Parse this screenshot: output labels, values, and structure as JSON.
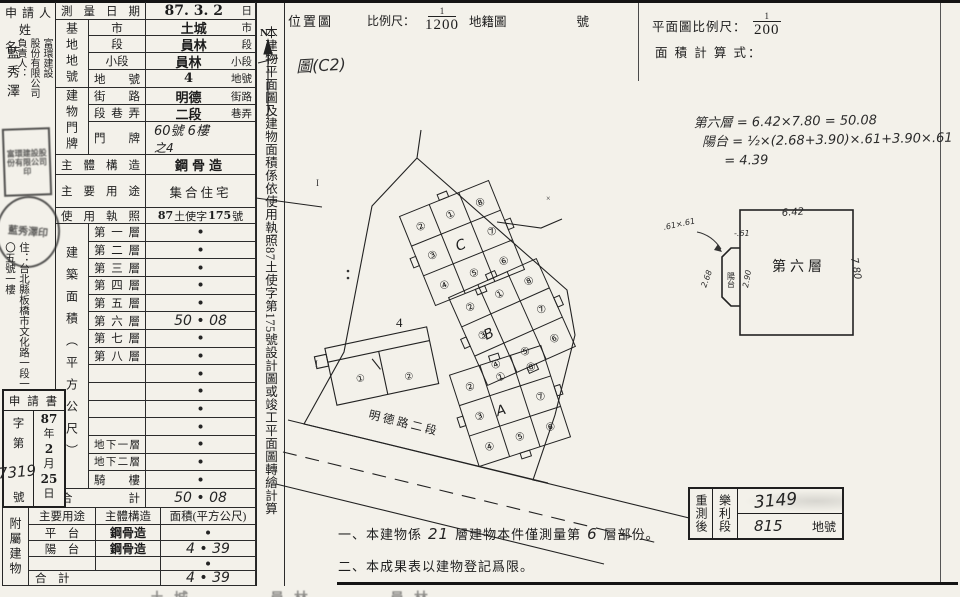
{
  "applicant": {
    "header_line1": "申 請 人",
    "header_line2": "姓　名",
    "company_block": "富環建設\n股份有限公司\n負責人：",
    "principal_name": "藍秀澤",
    "address": "住：台北縣板橋市文化路一段一〇五號一樓",
    "seal_square": "富環建設股份有限公司印",
    "seal_round": "藍秀澤印"
  },
  "form": {
    "survey_date": {
      "label": "測量日期",
      "value": "87. 3. 2",
      "suffix": "日"
    },
    "base": {
      "group": "基地地號",
      "rows": [
        {
          "label": "市",
          "value": "土城",
          "suffix": "市"
        },
        {
          "label": "段",
          "value": "員林",
          "suffix": "段"
        },
        {
          "label": "小段",
          "value": "員林",
          "suffix": "小段"
        },
        {
          "label": "地號",
          "value": "4",
          "suffix": "地號"
        }
      ]
    },
    "premise": {
      "group": "建物門牌",
      "street": {
        "label": "街路",
        "value": "明德",
        "suffix": "街路"
      },
      "section": {
        "label": "段巷弄",
        "value": "二段",
        "suffix": "巷弄"
      },
      "door": {
        "label": "門牌",
        "line1": "60號 6樓",
        "line2": "之4"
      }
    },
    "structure": {
      "label": "主體構造",
      "value": "鋼骨造"
    },
    "usage": {
      "label": "主要用途",
      "value": "集合住宅"
    },
    "license": {
      "label": "使用執照",
      "p1": "87",
      "p2": "土使字",
      "p3": "175",
      "p4": "號"
    },
    "floors": {
      "group": "建築面積（平方公尺）",
      "rows": [
        {
          "label": "第一層",
          "value": "•"
        },
        {
          "label": "第二層",
          "value": "•"
        },
        {
          "label": "第三層",
          "value": "•"
        },
        {
          "label": "第四層",
          "value": "•"
        },
        {
          "label": "第五層",
          "value": "•"
        },
        {
          "label": "第六層",
          "value": "50 • 08"
        },
        {
          "label": "第七層",
          "value": "•"
        },
        {
          "label": "第八層",
          "value": "•"
        },
        {
          "label": "",
          "value": "•"
        },
        {
          "label": "",
          "value": "•"
        },
        {
          "label": "",
          "value": "•"
        },
        {
          "label": "",
          "value": "•"
        },
        {
          "label": "地下一層",
          "value": "•"
        },
        {
          "label": "地下二層",
          "value": "•"
        },
        {
          "label": "騎　樓",
          "value": "•"
        }
      ],
      "total_label": "合　　　計",
      "total_value": "50 • 08"
    },
    "application": {
      "title": "申 請 書",
      "zi": "字",
      "di": "第",
      "number": "7319",
      "hao": "號",
      "year": "87",
      "year_u": "年",
      "month": "2",
      "month_u": "月",
      "day": "25",
      "day_u": "日"
    },
    "annex": {
      "group": "附屬建物",
      "h_use": "主要用途",
      "h_struct": "主體構造",
      "h_area": "面積(平方公尺)",
      "rows": [
        {
          "use": "平　台",
          "struct": "鋼骨造",
          "area": "•"
        },
        {
          "use": "陽　台",
          "struct": "鋼骨造",
          "area": "4 • 39"
        },
        {
          "use": "",
          "struct": "",
          "area": "•"
        }
      ],
      "total_label": "合　計",
      "total_area": "4 • 39"
    }
  },
  "strip_text": "本建物平面圖及建物面積係依使用執照87土使字第175號設計圖或竣工平面圖轉繪計算",
  "location_map": {
    "title": "位置圖",
    "scale_label": "比例尺：",
    "scale_num": "1",
    "scale_den": "1200",
    "map_type": "地籍圖",
    "number_suffix": "號",
    "north": "N",
    "annotation": "圖(C2)",
    "street": "明德路二段",
    "lot_number": "4",
    "cluster_a": "A",
    "cluster_b": "B",
    "cluster_c": "C",
    "units": [
      "①",
      "②",
      "③",
      "④",
      "⑤",
      "⑥",
      "⑦",
      "⑧"
    ],
    "low_units": [
      "①",
      "②"
    ]
  },
  "plan": {
    "scale_label": "平面圖比例尺：",
    "scale_num": "1",
    "scale_den": "200",
    "calc_label": "面 積 計 算 式：",
    "f1_label": "第六層",
    "f1": "= 6.42×7.80 = 50.08",
    "f2_label": "陽台",
    "f2": "= ½×(2.68+3.90)×.61+3.90×.61",
    "f3": "= 4.39",
    "room_label": "第六層",
    "dim_top": "6.42",
    "dim_right": "7.80",
    "balcony_label": "陽台",
    "dim_268": "2.68",
    "dim_290": "2.90",
    "dim_61": ".61×.61",
    "dim_m61": "-.61"
  },
  "resurvey": {
    "label": "重測後",
    "section": "樂利段",
    "number1": "3149",
    "number2": "815",
    "suffix": "地號"
  },
  "notes": {
    "n1_pre": "一、本建物係",
    "n1_hand1": "21",
    "n1_mid": "層建物本件僅測量第",
    "n1_hand2": "6",
    "n1_post": "層部份。",
    "n2": "二、本成果表以建物登記爲限。"
  },
  "bottom_cut": "土城　　　員林　　　員林"
}
